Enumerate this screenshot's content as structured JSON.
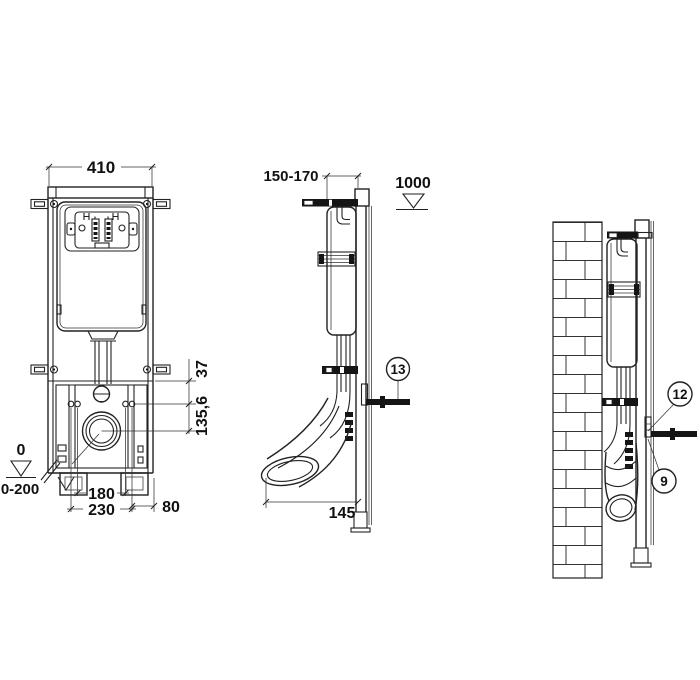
{
  "front_view": {
    "width": "410",
    "bracket_offset": "37",
    "outlet_center": "135,6",
    "bolt_spacing": "180",
    "fixing_spacing": "230",
    "edge_offset": "80",
    "floor_level": "0",
    "adjust_range": "0-200"
  },
  "side_view": {
    "depth_range": "150-170",
    "panel_height": "1000",
    "outlet_distance": "145",
    "callout_fixing": "13"
  },
  "wall_view": {
    "callout_rod": "12",
    "callout_bracket": "9"
  }
}
